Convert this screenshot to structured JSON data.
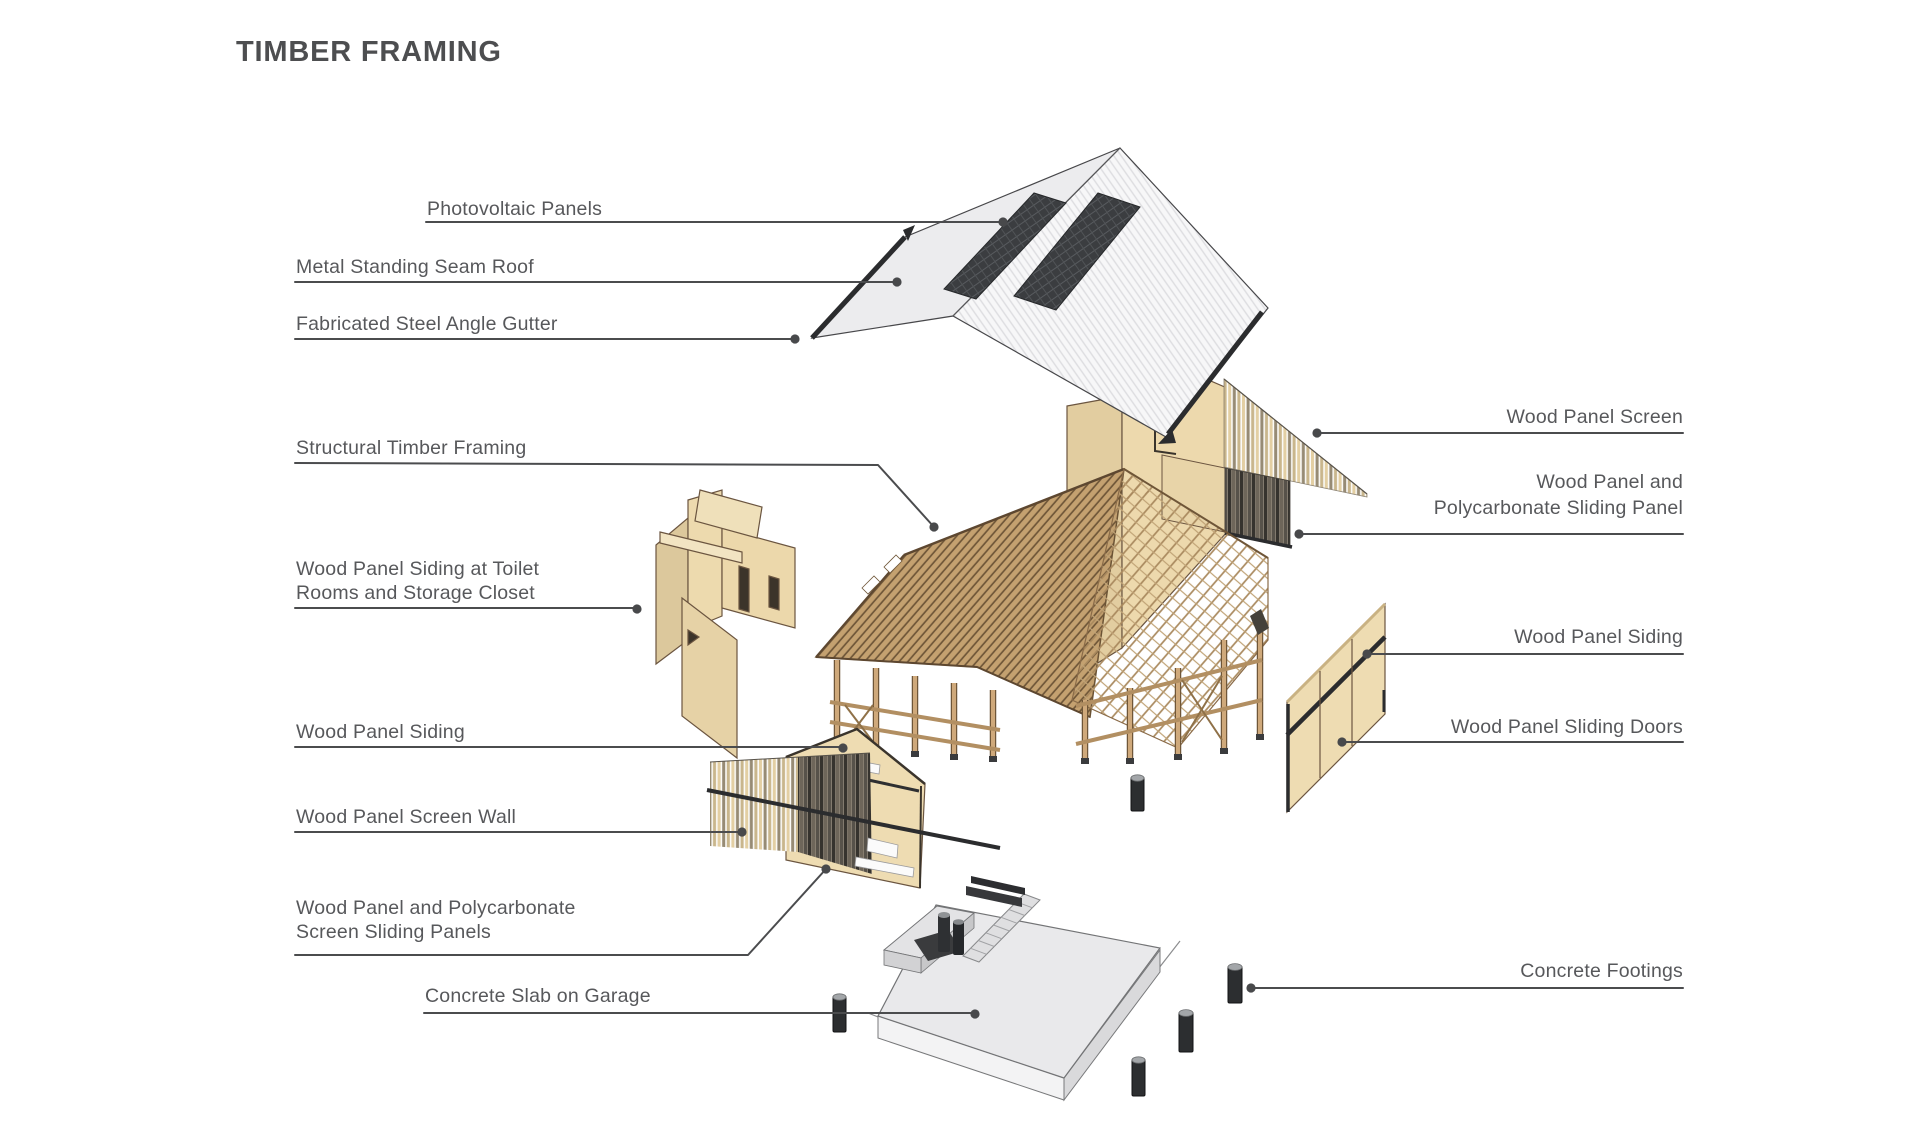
{
  "title": "TIMBER FRAMING",
  "labels": {
    "photovoltaic": "Photovoltaic Panels",
    "metal_roof": "Metal Standing Seam Roof",
    "gutter": "Fabricated Steel Angle Gutter",
    "framing": "Structural Timber Framing",
    "toilet_siding_1": "Wood Panel Siding at Toilet",
    "toilet_siding_2": "Rooms and Storage Closet",
    "siding_left": "Wood Panel Siding",
    "screen_wall": "Wood Panel Screen Wall",
    "sliding_panels_1": "Wood Panel and Polycarbonate",
    "sliding_panels_2": "Screen Sliding Panels",
    "slab": "Concrete Slab on Garage",
    "screen_right": "Wood Panel Screen",
    "sliding_panel_right_1": "Wood Panel and",
    "sliding_panel_right_2": "Polycarbonate Sliding Panel",
    "siding_right": "Wood Panel Siding",
    "sliding_doors": "Wood Panel Sliding Doors",
    "footings": "Concrete Footings"
  },
  "palette": {
    "label_text": "#57585b",
    "leader_line": "#4b4c4e",
    "title_text": "#4d4e50",
    "wood_light": "#ecd9ae",
    "wood_mid": "#c9a87a",
    "rafter_brown": "#6f5638",
    "roof_white": "#f7f7f8",
    "roof_gray": "#ececee",
    "steel_dark": "#2b2c2e",
    "pv_panel": "#3b3d40",
    "concrete_light": "#e9e9eb",
    "concrete_dark": "#d9d9db",
    "fixture_dark": "#2e3033"
  }
}
